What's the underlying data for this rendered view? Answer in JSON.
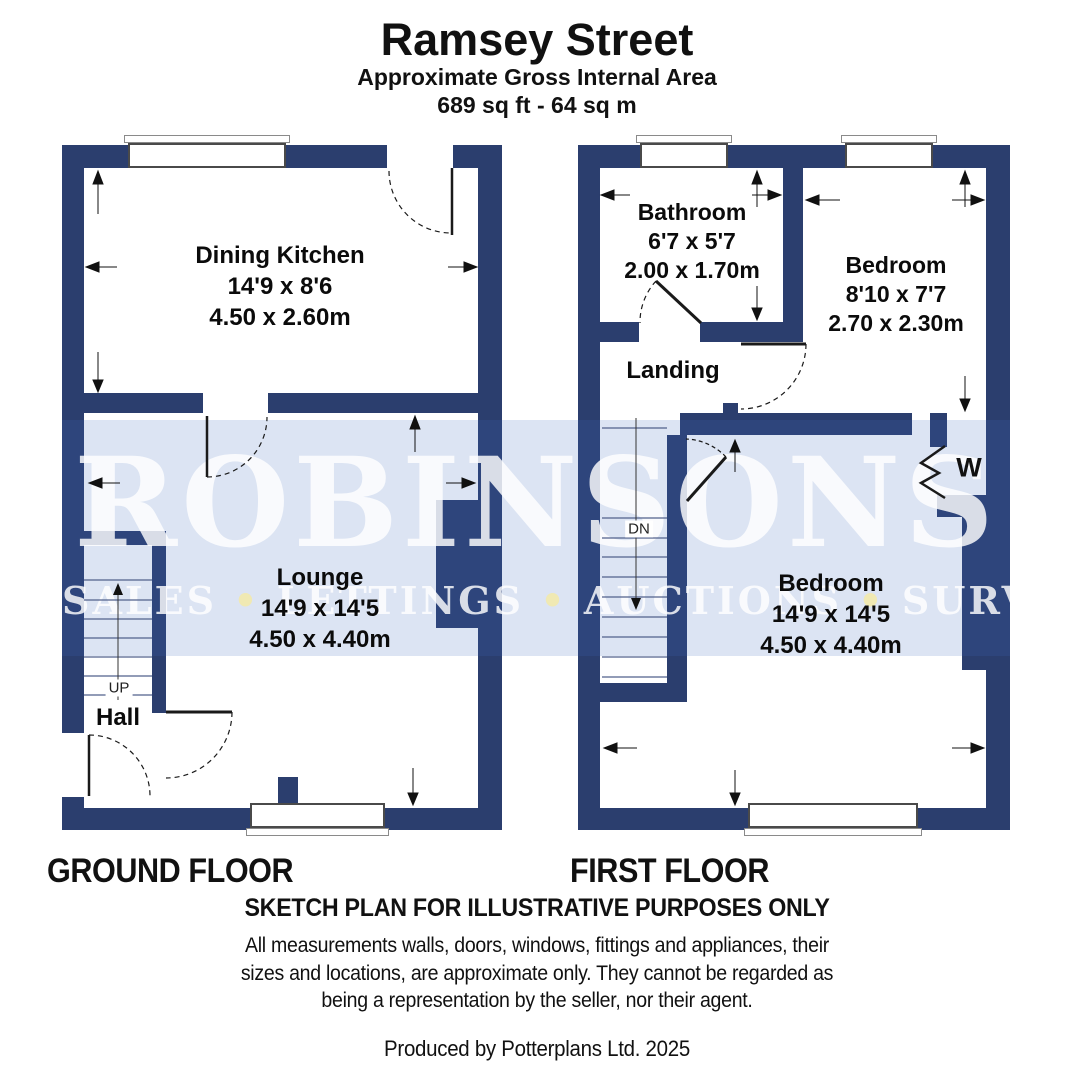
{
  "header": {
    "title": "Ramsey Street",
    "subtitle": "Approximate Gross Internal Area",
    "area": "689 sq ft - 64 sq m"
  },
  "watermark": {
    "name": "ROBINSONS",
    "tagline_words": [
      "SALES",
      "LETTINGS",
      "AUCTIONS",
      "SURVEYS"
    ]
  },
  "colors": {
    "wall": "#2b3e6e",
    "watermark_band": "#dce4f3",
    "watermark_text": "#ffffff"
  },
  "ground_floor": {
    "caption": "GROUND FLOOR",
    "stairs_label": "UP",
    "rooms": {
      "dining_kitchen": {
        "name": "Dining Kitchen",
        "imperial": "14'9 x 8'6",
        "metric": "4.50 x 2.60m"
      },
      "lounge": {
        "name": "Lounge",
        "imperial": "14'9 x 14'5",
        "metric": "4.50 x 4.40m"
      },
      "hall": {
        "name": "Hall"
      }
    }
  },
  "first_floor": {
    "caption": "FIRST FLOOR",
    "stairs_label": "DN",
    "rooms": {
      "bathroom": {
        "name": "Bathroom",
        "imperial": "6'7 x 5'7",
        "metric": "2.00 x 1.70m"
      },
      "bedroom_front": {
        "name": "Bedroom",
        "imperial": "8'10 x 7'7",
        "metric": "2.70 x 2.30m"
      },
      "landing": {
        "name": "Landing"
      },
      "bedroom_main": {
        "name": "Bedroom",
        "imperial": "14'9 x 14'5",
        "metric": "4.50 x 4.40m"
      },
      "wardrobe": {
        "name": "W"
      }
    }
  },
  "footer": {
    "disclaimer_title": "SKETCH PLAN FOR ILLUSTRATIVE PURPOSES ONLY",
    "disclaimer_lines": [
      "All measurements walls, doors, windows, fittings and appliances, their",
      "sizes and locations, are approximate only. They cannot be regarded as",
      "being a representation by the seller, nor their agent."
    ],
    "produced_by": "Produced by Potterplans Ltd. 2025"
  }
}
